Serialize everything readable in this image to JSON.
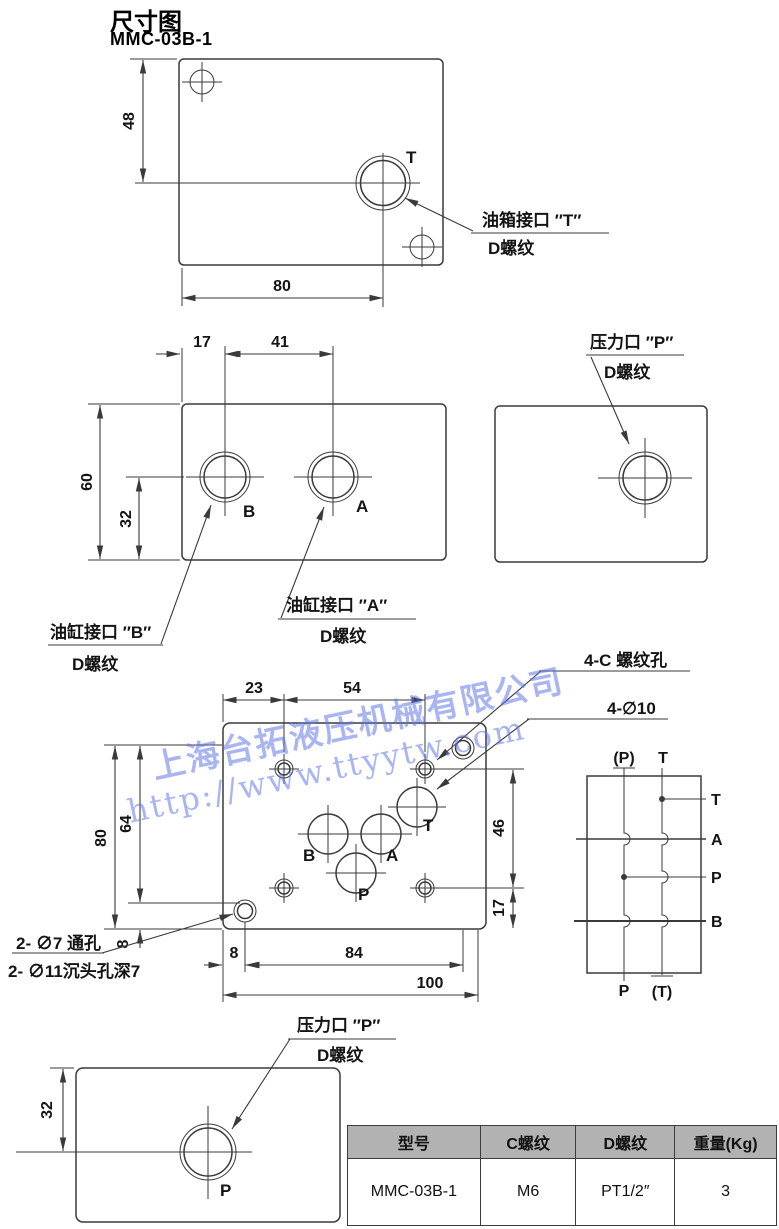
{
  "page": {
    "title": "尺寸图",
    "model": "MMC-03B-1"
  },
  "watermark": {
    "company": "上海台拓液压机械有限公司",
    "url": "http://www.ttyytw.com"
  },
  "top_view": {
    "dim_height": "48",
    "dim_width": "80",
    "port": "T",
    "note_line1": "油箱接口 ″T″",
    "note_line2": "D螺纹"
  },
  "mid_view": {
    "dim_17": "17",
    "dim_41": "41",
    "dim_60": "60",
    "dim_32": "32",
    "port_b": "B",
    "port_a": "A",
    "note_b_line1": "油缸接口 ″B″",
    "note_b_line2": "D螺纹",
    "note_a_line1": "油缸接口 ″A″",
    "note_a_line2": "D螺纹"
  },
  "side_view": {
    "note_line1": "压力口 ″P″",
    "note_line2": "D螺纹"
  },
  "main_view": {
    "dim_23": "23",
    "dim_54": "54",
    "dim_80": "80",
    "dim_64": "64",
    "dim_46": "46",
    "dim_17": "17",
    "dim_8_left": "8",
    "dim_8_bottom": "8",
    "dim_84": "84",
    "dim_100": "100",
    "port_b": "B",
    "port_a": "A",
    "port_p": "P",
    "port_t": "T",
    "note_4c": "4-C 螺纹孔",
    "note_4d10": "4-∅10",
    "note_holes_line1": "2- ∅7 通孔",
    "note_holes_line2": "2- ∅11沉头孔深7",
    "note_p_line1": "压力口 ″P″",
    "note_p_line2": "D螺纹"
  },
  "bottom_view": {
    "dim_32": "32",
    "port": "P"
  },
  "schematic": {
    "top_left": "(P)",
    "top_right": "T",
    "right_t": "T",
    "right_a": "A",
    "right_p": "P",
    "right_b": "B",
    "bottom_left": "P",
    "bottom_right": "(T)"
  },
  "table": {
    "headers": [
      "型号",
      "C螺纹",
      "D螺纹",
      "重量(Kg)"
    ],
    "row": [
      "MMC-03B-1",
      "M6",
      "PT1/2″",
      "3"
    ]
  }
}
